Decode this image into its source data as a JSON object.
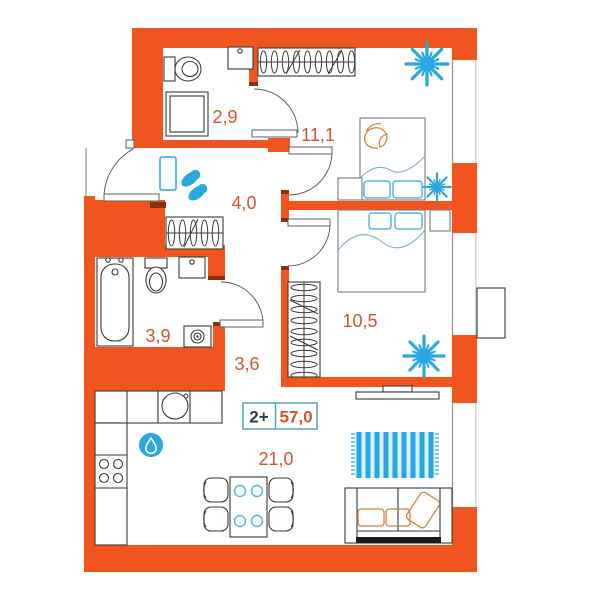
{
  "plan": {
    "badge": {
      "unit_type": "2+",
      "area_total": "57,0"
    },
    "rooms": [
      {
        "name": "wc",
        "area": "2,9"
      },
      {
        "name": "bedroom-1",
        "area": "11,1"
      },
      {
        "name": "hallway",
        "area": "4,0"
      },
      {
        "name": "bathroom",
        "area": "3,9"
      },
      {
        "name": "corridor",
        "area": "3,6"
      },
      {
        "name": "bedroom-2",
        "area": "10,5"
      },
      {
        "name": "living-kitchen",
        "area": "21,0"
      }
    ],
    "icons": [
      "toilet-icon",
      "shower-icon",
      "sink-icon",
      "bathtub-icon",
      "washing-machine-icon",
      "wardrobe-icon",
      "bed-icon",
      "plant-icon",
      "mirror-icon",
      "slippers-icon",
      "kitchen-sink-icon",
      "stove-icon",
      "water-drop-icon",
      "dining-table-icon",
      "chair-icon",
      "rug-icon",
      "sofa-icon",
      "tv-icon",
      "ac-unit-icon",
      "door-arc",
      "window"
    ],
    "colors": {
      "wall": "#F2541F",
      "accent": "#29A7DF",
      "accent_light": "#55B6E6",
      "label_text": "#D4532A",
      "badge_border": "#4FA5BC",
      "badge_text_dark": "#2E3D4A",
      "furniture": "#3a3a3a",
      "blanket": "#86AFC6",
      "art": "#D4823F",
      "jamb": "#8A2F10"
    }
  }
}
